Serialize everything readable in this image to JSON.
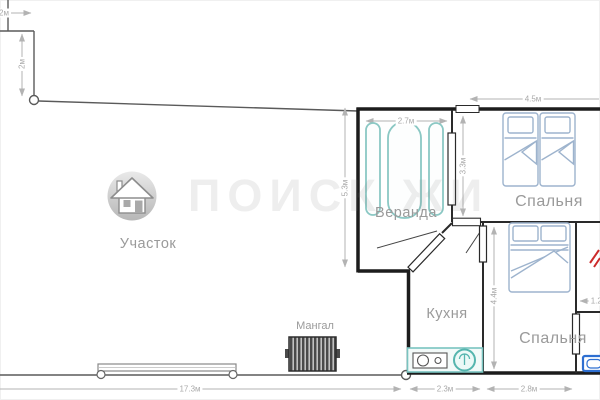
{
  "watermark_text": "ПОИСК ЖИ",
  "plot": {
    "label": "Участок"
  },
  "rooms": {
    "veranda": {
      "label": "Веранда"
    },
    "bedroom_top": {
      "label": "Спальня"
    },
    "bedroom_bottom": {
      "label": "Спальня"
    },
    "kitchen": {
      "label": "Кухня"
    }
  },
  "outdoor": {
    "mangal_label": "Мангал"
  },
  "dimensions": {
    "plot_top_width": "2м",
    "plot_top_height": "2м",
    "veranda_width": "2.7м",
    "bedroom_top_width": "4.5м",
    "house_left_height": "5.3м",
    "veranda_right_height": "3.3м",
    "kitchen_height": "4.4м",
    "kitchen_width": "2.3м",
    "bedroom_bottom_width": "2.8м",
    "bathroom_width": "1.2м",
    "plot_bottom_width": "17.3м"
  },
  "colors": {
    "wall": "#1c1c1c",
    "interior_wall": "#2a2a2a",
    "dimension": "#b3b3b3",
    "label": "#9a9a9a",
    "veranda_furniture": "#8bc8c4",
    "bed_outline": "#9db3cd",
    "kitchen_accent": "#55b5ae",
    "sink_blue": "#2e6fd1",
    "red_mark": "#cc2b2b",
    "mangal_fill": "#4a4a4a"
  }
}
